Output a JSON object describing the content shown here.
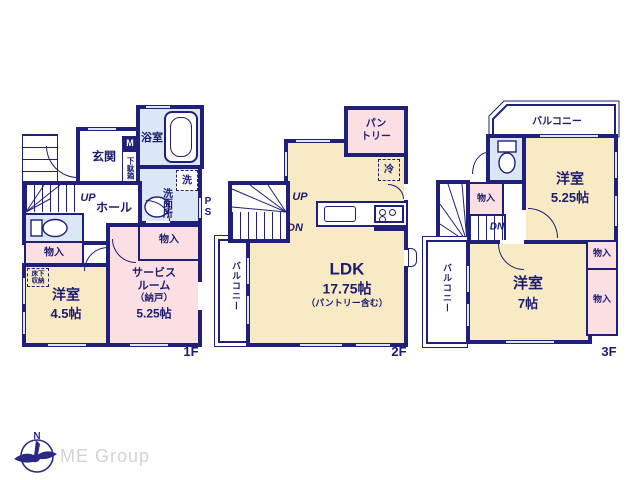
{
  "branding": {
    "logo": "ME Group"
  },
  "f1": {
    "label": "1F",
    "genkan": "玄関",
    "m": "M",
    "getabako": "下駄箱",
    "bath": "浴室",
    "washer": "洗",
    "washroom": "洗面所",
    "ps": "PS",
    "up": "UP",
    "hall": "ホール",
    "closet_l": "物入",
    "closet_r": "物入",
    "underfloor_1": "床下",
    "underfloor_2": "収納",
    "room_name": "洋室",
    "room_size": "4.5帖",
    "service_1": "サービス",
    "service_2": "ルーム",
    "service_3": "（納戸）",
    "service_4": "5.25帖"
  },
  "f2": {
    "label": "2F",
    "pantry_1": "パン",
    "pantry_2": "トリー",
    "fridge": "冷",
    "up": "UP",
    "dn": "DN",
    "balcony": "バルコニー",
    "ldk": "LDK",
    "ldk_size": "17.75帖",
    "ldk_note": "（パントリー含む）"
  },
  "f3": {
    "label": "3F",
    "balcony_top": "バルコニー",
    "balcony_left": "バルコニー",
    "closet_top": "物入",
    "dn": "DN",
    "room_a": "洋室",
    "room_a_size": "5.25帖",
    "room_b": "洋室",
    "room_b_size": "7帖",
    "closet_r1": "物入",
    "closet_r2": "物入"
  }
}
